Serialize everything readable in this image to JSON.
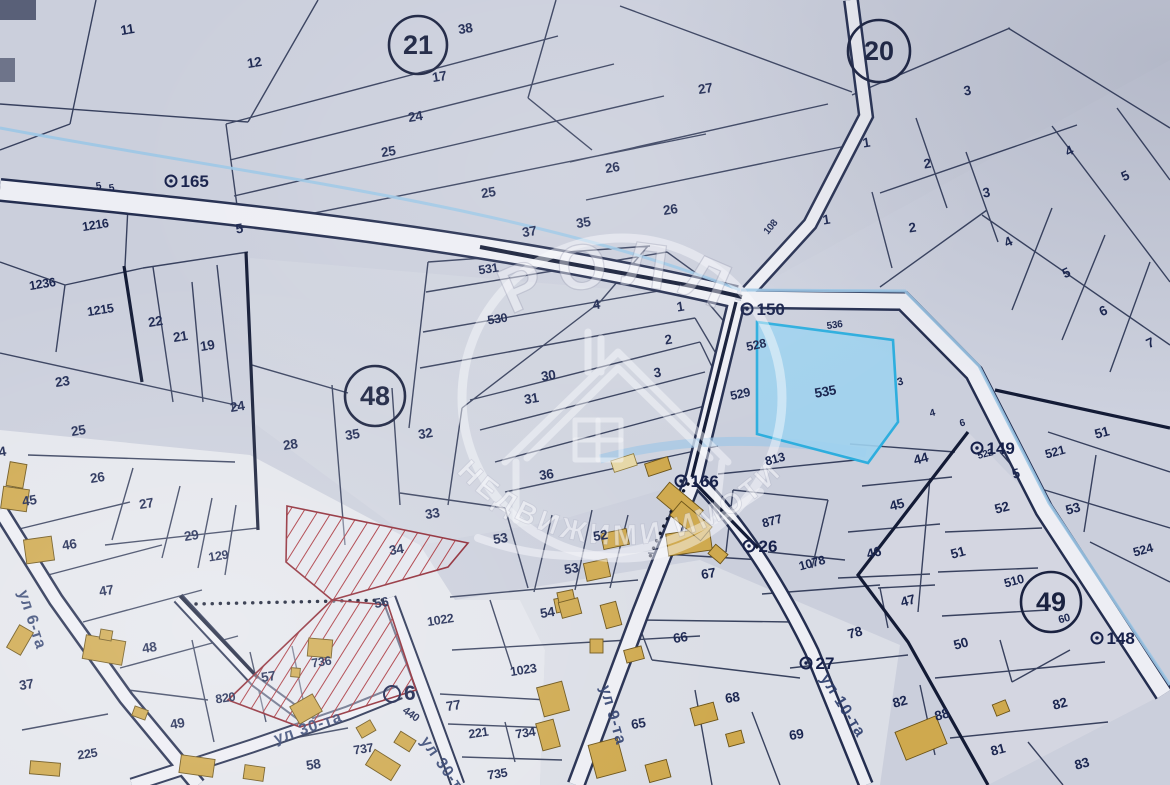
{
  "watermark": {
    "brand": "РОЛЛ",
    "subtitle": "НЕДВИЖИМИ ИМОТИ"
  },
  "highlight": {
    "parcel": "535"
  },
  "colors": {
    "background": "#cbcfdc",
    "parcel_line": "#2a3452",
    "road_fill": "#edeef4",
    "stream": "#9cc6e6",
    "highlight_fill": "#9fd2ee",
    "highlight_border": "#2eaede",
    "hatch_red": "#a8323a",
    "building_fill": "#cfa94e",
    "label_text": "#1b2650",
    "street_text": "#2e3f6e"
  },
  "quarters": [
    {
      "n": "21",
      "x": 418,
      "y": 45,
      "r": 29
    },
    {
      "n": "20",
      "x": 879,
      "y": 51,
      "r": 31
    },
    {
      "n": "48",
      "x": 375,
      "y": 396,
      "r": 30
    },
    {
      "n": "49",
      "x": 1051,
      "y": 602,
      "r": 30
    }
  ],
  "survey_points": [
    {
      "n": "165",
      "x": 171,
      "y": 181
    },
    {
      "n": "150",
      "x": 747,
      "y": 309
    },
    {
      "n": "166",
      "x": 681,
      "y": 481
    },
    {
      "n": "26",
      "x": 749,
      "y": 546
    },
    {
      "n": "149",
      "x": 977,
      "y": 448
    },
    {
      "n": "148",
      "x": 1097,
      "y": 638
    },
    {
      "n": "6",
      "x": 392,
      "y": 694,
      "big": true
    },
    {
      "n": "27",
      "x": 806,
      "y": 663
    }
  ],
  "street_labels": [
    {
      "t": "ул 6-та",
      "x": 18,
      "y": 592,
      "r": 72
    },
    {
      "t": "ул 9-та",
      "x": 600,
      "y": 687,
      "r": 74
    },
    {
      "t": "ул 10-та",
      "x": 820,
      "y": 678,
      "r": 58
    },
    {
      "t": "ул 30-та",
      "x": 276,
      "y": 744,
      "r": -19
    },
    {
      "t": "ул 30-та",
      "x": 420,
      "y": 741,
      "r": 55
    }
  ],
  "parcel_labels": [
    {
      "t": "11",
      "x": 128,
      "y": 34
    },
    {
      "t": "12",
      "x": 255,
      "y": 67
    },
    {
      "t": "38",
      "x": 466,
      "y": 33
    },
    {
      "t": "17",
      "x": 440,
      "y": 81
    },
    {
      "t": "24",
      "x": 416,
      "y": 121
    },
    {
      "t": "25",
      "x": 389,
      "y": 156
    },
    {
      "t": "25",
      "x": 489,
      "y": 197
    },
    {
      "t": "37",
      "x": 530,
      "y": 236
    },
    {
      "t": "35",
      "x": 584,
      "y": 227
    },
    {
      "t": "26",
      "x": 613,
      "y": 172
    },
    {
      "t": "26",
      "x": 671,
      "y": 214
    },
    {
      "t": "27",
      "x": 706,
      "y": 93
    },
    {
      "t": "108",
      "x": 773,
      "y": 229,
      "s": 10,
      "r": -50
    },
    {
      "t": "5",
      "x": 99,
      "y": 189,
      "s": 10
    },
    {
      "t": "5",
      "x": 112,
      "y": 191,
      "s": 10
    },
    {
      "t": "1216",
      "x": 96,
      "y": 229,
      "s": 12.5
    },
    {
      "t": "5",
      "x": 240,
      "y": 233
    },
    {
      "t": "3",
      "x": 968,
      "y": 95
    },
    {
      "t": "1",
      "x": 867,
      "y": 147
    },
    {
      "t": "2",
      "x": 928,
      "y": 168
    },
    {
      "t": "3",
      "x": 987,
      "y": 197
    },
    {
      "t": "1",
      "x": 827,
      "y": 224
    },
    {
      "t": "2",
      "x": 913,
      "y": 232
    },
    {
      "t": "4",
      "x": 1071,
      "y": 155,
      "r": -25
    },
    {
      "t": "5",
      "x": 1127,
      "y": 180,
      "r": -25
    },
    {
      "t": "4",
      "x": 1010,
      "y": 246,
      "r": -25
    },
    {
      "t": "5",
      "x": 1068,
      "y": 277,
      "r": -25
    },
    {
      "t": "6",
      "x": 1105,
      "y": 315,
      "r": -25
    },
    {
      "t": "7",
      "x": 1152,
      "y": 347,
      "r": -25
    },
    {
      "t": "1236",
      "x": 43,
      "y": 288,
      "s": 12.5
    },
    {
      "t": "1215",
      "x": 101,
      "y": 314,
      "s": 12.5
    },
    {
      "t": "22",
      "x": 156,
      "y": 326
    },
    {
      "t": "21",
      "x": 181,
      "y": 341
    },
    {
      "t": "19",
      "x": 208,
      "y": 350
    },
    {
      "t": "23",
      "x": 63,
      "y": 386
    },
    {
      "t": "24",
      "x": 238,
      "y": 411
    },
    {
      "t": "25",
      "x": 79,
      "y": 435
    },
    {
      "t": "28",
      "x": 291,
      "y": 449
    },
    {
      "t": "26",
      "x": 98,
      "y": 482
    },
    {
      "t": "27",
      "x": 147,
      "y": 508
    },
    {
      "t": "29",
      "x": 192,
      "y": 540
    },
    {
      "t": "129",
      "x": 219,
      "y": 560,
      "s": 12.5
    },
    {
      "t": "45",
      "x": 30,
      "y": 505
    },
    {
      "t": "46",
      "x": 70,
      "y": 549
    },
    {
      "t": "47",
      "x": 107,
      "y": 595
    },
    {
      "t": "4",
      "x": 3,
      "y": 456
    },
    {
      "t": "531",
      "x": 489,
      "y": 273,
      "s": 12.5
    },
    {
      "t": "530",
      "x": 498,
      "y": 323,
      "s": 12.5
    },
    {
      "t": "4",
      "x": 597,
      "y": 309
    },
    {
      "t": "1",
      "x": 681,
      "y": 311
    },
    {
      "t": "2",
      "x": 669,
      "y": 344
    },
    {
      "t": "3",
      "x": 658,
      "y": 377
    },
    {
      "t": "30",
      "x": 549,
      "y": 380
    },
    {
      "t": "31",
      "x": 532,
      "y": 403
    },
    {
      "t": "36",
      "x": 547,
      "y": 479
    },
    {
      "t": "35",
      "x": 353,
      "y": 439
    },
    {
      "t": "32",
      "x": 426,
      "y": 438
    },
    {
      "t": "33",
      "x": 433,
      "y": 518
    },
    {
      "t": "34",
      "x": 397,
      "y": 554
    },
    {
      "t": "53",
      "x": 501,
      "y": 543
    },
    {
      "t": "52",
      "x": 601,
      "y": 540
    },
    {
      "t": "53",
      "x": 572,
      "y": 573
    },
    {
      "t": "56",
      "x": 382,
      "y": 607
    },
    {
      "t": "528",
      "x": 757,
      "y": 349,
      "s": 12.5,
      "r": -12
    },
    {
      "t": "529",
      "x": 741,
      "y": 398,
      "s": 12.5,
      "r": -12
    },
    {
      "t": "535",
      "x": 826,
      "y": 396,
      "r": -10
    },
    {
      "t": "536",
      "x": 835,
      "y": 328,
      "s": 10,
      "r": -8
    },
    {
      "t": "3",
      "x": 901,
      "y": 385,
      "s": 11,
      "r": -15
    },
    {
      "t": "4",
      "x": 933,
      "y": 416,
      "s": 10,
      "r": -15
    },
    {
      "t": "6",
      "x": 963,
      "y": 426,
      "s": 10,
      "r": -15
    },
    {
      "t": "44",
      "x": 922,
      "y": 463,
      "r": -15
    },
    {
      "t": "813",
      "x": 776,
      "y": 463,
      "s": 12.5,
      "r": -15
    },
    {
      "t": "877",
      "x": 773,
      "y": 525,
      "s": 12.5,
      "r": -15
    },
    {
      "t": "1078",
      "x": 813,
      "y": 567,
      "s": 12.5,
      "r": -15
    },
    {
      "t": "45",
      "x": 898,
      "y": 509,
      "r": -15
    },
    {
      "t": "46",
      "x": 875,
      "y": 557,
      "r": -15
    },
    {
      "t": "47",
      "x": 909,
      "y": 605,
      "r": -15
    },
    {
      "t": "51",
      "x": 959,
      "y": 557,
      "r": -15
    },
    {
      "t": "52",
      "x": 1003,
      "y": 512,
      "r": -15
    },
    {
      "t": "510",
      "x": 1015,
      "y": 585,
      "s": 12.5,
      "r": -15
    },
    {
      "t": "5",
      "x": 1017,
      "y": 478,
      "r": -15
    },
    {
      "t": "53",
      "x": 1074,
      "y": 513,
      "r": -15
    },
    {
      "t": "521",
      "x": 1056,
      "y": 456,
      "s": 12.5,
      "r": -15
    },
    {
      "t": "522",
      "x": 986,
      "y": 457,
      "s": 10,
      "r": -15
    },
    {
      "t": "51",
      "x": 1103,
      "y": 437,
      "r": -15
    },
    {
      "t": "524",
      "x": 1144,
      "y": 554,
      "s": 12.5,
      "r": -15
    },
    {
      "t": "50",
      "x": 962,
      "y": 648,
      "r": -15
    },
    {
      "t": "60",
      "x": 1065,
      "y": 622,
      "s": 11,
      "r": -15
    },
    {
      "t": "48",
      "x": 150,
      "y": 652
    },
    {
      "t": "49",
      "x": 178,
      "y": 728
    },
    {
      "t": "820",
      "x": 226,
      "y": 702,
      "s": 12.5
    },
    {
      "t": "57",
      "x": 269,
      "y": 681
    },
    {
      "t": "736",
      "x": 322,
      "y": 666,
      "s": 12.5
    },
    {
      "t": "225",
      "x": 88,
      "y": 758,
      "s": 12.5
    },
    {
      "t": "58",
      "x": 314,
      "y": 769
    },
    {
      "t": "37",
      "x": 27,
      "y": 689
    },
    {
      "t": "737",
      "x": 364,
      "y": 753,
      "s": 12.5
    },
    {
      "t": "1022",
      "x": 441,
      "y": 624,
      "s": 12.5
    },
    {
      "t": "54",
      "x": 548,
      "y": 617
    },
    {
      "t": "1023",
      "x": 524,
      "y": 674,
      "s": 12.5
    },
    {
      "t": "77",
      "x": 454,
      "y": 710
    },
    {
      "t": "221",
      "x": 479,
      "y": 737,
      "s": 12.5
    },
    {
      "t": "734",
      "x": 526,
      "y": 737,
      "s": 12.5
    },
    {
      "t": "735",
      "x": 498,
      "y": 778,
      "s": 12.5
    },
    {
      "t": "440",
      "x": 409,
      "y": 717,
      "s": 11,
      "r": 35
    },
    {
      "t": "66",
      "x": 681,
      "y": 642
    },
    {
      "t": "65",
      "x": 639,
      "y": 728
    },
    {
      "t": "68",
      "x": 733,
      "y": 702
    },
    {
      "t": "69",
      "x": 797,
      "y": 739
    },
    {
      "t": "67",
      "x": 709,
      "y": 578
    },
    {
      "t": "78",
      "x": 856,
      "y": 637,
      "r": -15
    },
    {
      "t": "82",
      "x": 901,
      "y": 706,
      "r": -15
    },
    {
      "t": "88",
      "x": 943,
      "y": 719,
      "r": -15
    },
    {
      "t": "81",
      "x": 999,
      "y": 754,
      "r": -15
    },
    {
      "t": "82",
      "x": 1061,
      "y": 708,
      "r": -15
    },
    {
      "t": "83",
      "x": 1083,
      "y": 768,
      "r": -15
    }
  ],
  "buildings": [
    [
      8,
      463,
      17,
      24,
      10
    ],
    [
      2,
      488,
      26,
      22,
      8
    ],
    [
      25,
      538,
      28,
      24,
      -8
    ],
    [
      12,
      627,
      16,
      26,
      30
    ],
    [
      84,
      638,
      40,
      24,
      10
    ],
    [
      100,
      630,
      12,
      10,
      10
    ],
    [
      133,
      708,
      14,
      10,
      20
    ],
    [
      30,
      762,
      30,
      13,
      5
    ],
    [
      180,
      757,
      34,
      18,
      8
    ],
    [
      244,
      766,
      20,
      14,
      8
    ],
    [
      308,
      639,
      24,
      18,
      5
    ],
    [
      291,
      668,
      9,
      9,
      5
    ],
    [
      293,
      699,
      26,
      20,
      -30
    ],
    [
      358,
      723,
      16,
      12,
      -30
    ],
    [
      368,
      756,
      30,
      18,
      32
    ],
    [
      396,
      735,
      18,
      13,
      32
    ],
    [
      555,
      597,
      20,
      14,
      -12
    ],
    [
      585,
      561,
      24,
      18,
      -12
    ],
    [
      559,
      591,
      16,
      22,
      -12
    ],
    [
      602,
      531,
      26,
      16,
      -12
    ],
    [
      667,
      531,
      44,
      22,
      -8
    ],
    [
      560,
      600,
      20,
      16,
      -15
    ],
    [
      603,
      603,
      16,
      24,
      -15
    ],
    [
      590,
      639,
      13,
      14,
      0
    ],
    [
      625,
      648,
      18,
      13,
      -15
    ],
    [
      540,
      684,
      26,
      30,
      -15
    ],
    [
      539,
      721,
      18,
      28,
      -15
    ],
    [
      592,
      741,
      30,
      34,
      -15
    ],
    [
      647,
      762,
      22,
      18,
      -15
    ],
    [
      692,
      705,
      24,
      18,
      -15
    ],
    [
      727,
      732,
      16,
      13,
      -15
    ],
    [
      646,
      460,
      24,
      13,
      -18
    ],
    [
      612,
      457,
      24,
      12,
      -18,
      1
    ],
    [
      658,
      494,
      44,
      20,
      40
    ],
    [
      671,
      512,
      40,
      18,
      40
    ],
    [
      710,
      548,
      16,
      12,
      40
    ],
    [
      899,
      723,
      44,
      30,
      -22
    ],
    [
      994,
      702,
      14,
      12,
      -22
    ]
  ]
}
